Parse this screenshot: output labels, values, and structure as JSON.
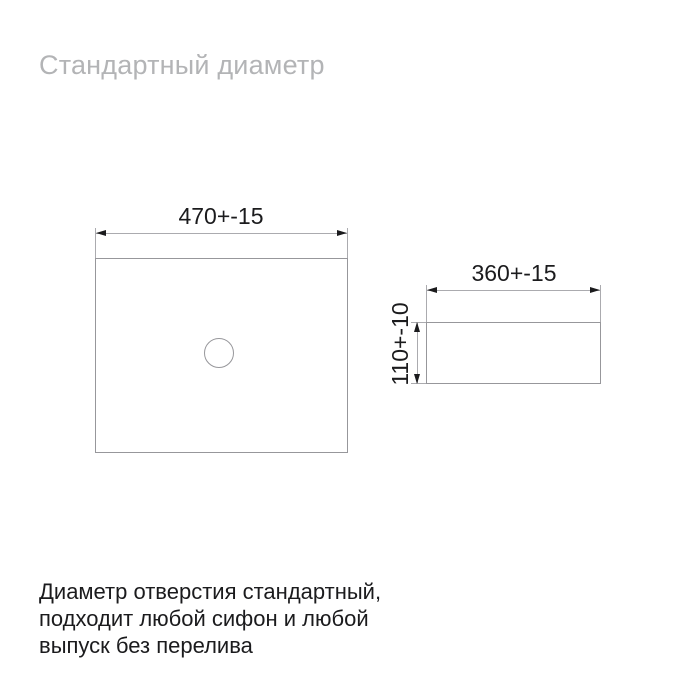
{
  "title": "Стандартный диаметр",
  "diagram": {
    "top_view": {
      "width_dimension": "470+-15"
    },
    "side_view": {
      "width_dimension": "360+-15",
      "height_dimension": "110+-10"
    }
  },
  "footer": {
    "lines": [
      "Диаметр отверстия стандартный,",
      "подходит любой сифон и любой",
      "выпуск без перелива"
    ]
  },
  "colors": {
    "background": "#ffffff",
    "title_text": "#b3b4b6",
    "body_text": "#1b1b1d",
    "outline": "#97979b",
    "dimension_line": "#ababaf",
    "arrow": "#1b1b1d"
  }
}
